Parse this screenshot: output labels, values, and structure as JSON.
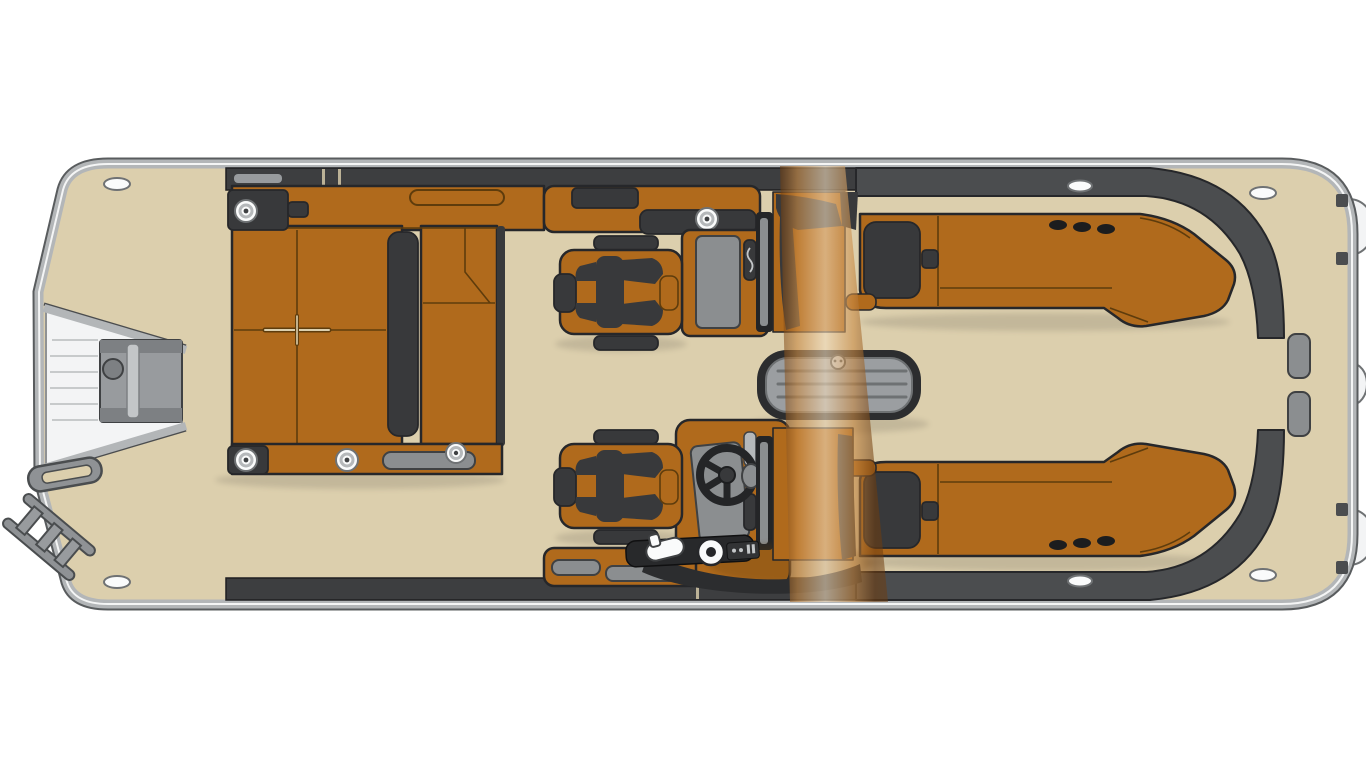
{
  "diagram": {
    "kind": "pontoon-boat-floor-plan",
    "view": "top-down-deck-layout"
  },
  "colors": {
    "background": "#ffffff",
    "deck": "#dccfad",
    "rim-silver": "#b3b6b8",
    "rim-dark": "#595c5e",
    "rim-light": "#f4f5f5",
    "outline": "#26272a",
    "outline-soft": "#1e1f21",
    "fence-dark": "#3d3e40",
    "stern-trim": "#4b4d4f",
    "seat-orange": "#b06a1c",
    "seat-line": "#5e3c0c",
    "cushion-dark": "#38393b",
    "console-gray": "#8b8e90",
    "panel-light": "#b5b8ba",
    "panel-edge": "#3f4143",
    "platform-white": "#f3f4f5",
    "platform-edge": "#8f9294",
    "gate-gray": "#989b9e",
    "gate-dark": "#7d8083",
    "gate-light": "#c3c6c8",
    "slat-line": "#c7cacb",
    "table-frame": "#2c2d2f",
    "table-gray": "#9b9ea1",
    "table-line": "#6e7173",
    "ladder-gray": "#8f9295",
    "ladder-edge": "#4a4d4f",
    "fitting-white": "#fafbfb",
    "fitting-edge": "#6f7274",
    "speaker-black": "#1c1d1e",
    "wheel-black": "#242527",
    "arch-deep": "#6e3c0e",
    "arch-copper": "#c98a44",
    "arch-light": "#f3ddbd",
    "shadow": "#45413a"
  },
  "components": {
    "hull": [
      "deck",
      "bow",
      "stern",
      "rub-rail",
      "bow-cleat-port",
      "bow-cleat-starboard",
      "stern-cleat-port",
      "stern-cleat-starboard",
      "midship-cleat-port",
      "midship-cleat-starboard",
      "engine-pod-top",
      "engine-pod-middle",
      "engine-pod-bottom"
    ],
    "bow_area": [
      "boarding-platform",
      "boarding-gate",
      "boarding-ladder",
      "grab-handle",
      "l-lounge",
      "chaise-pad",
      "entry-tread",
      "cup-holders"
    ],
    "helm_area": [
      "port-captain-chair",
      "starboard-captain-chair",
      "port-console",
      "helm-console",
      "steering-wheel",
      "throttle",
      "gauge",
      "windshield-port",
      "windshield-starboard",
      "storage-cabinet-forward",
      "storage-cabinet-aft"
    ],
    "amidships": [
      "ski-arch",
      "cocktail-table"
    ],
    "stern_area": [
      "port-stern-lounge",
      "starboard-stern-lounge",
      "speakers",
      "stern-gate-pads",
      "rear-walkway"
    ]
  }
}
